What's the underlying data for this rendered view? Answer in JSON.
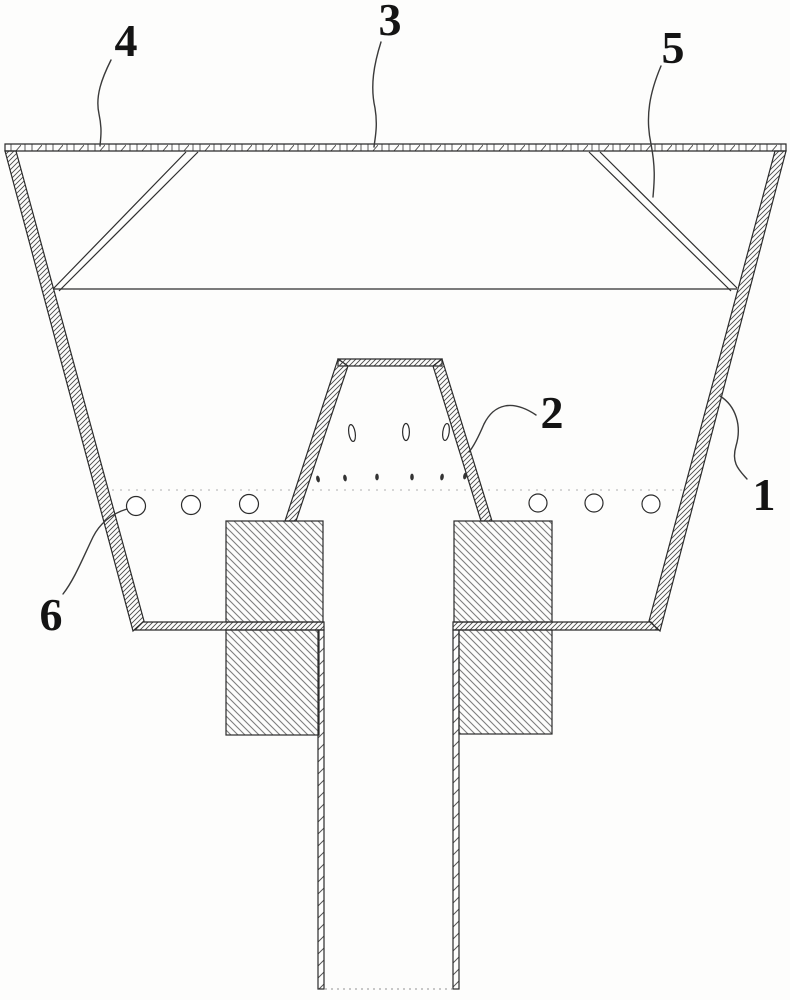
{
  "figure": {
    "kind": "patent-style cross-section technical drawing of a hopper/crucible with center discharge tube",
    "callouts": [
      {
        "text": "1"
      },
      {
        "text": "2"
      },
      {
        "text": "3"
      },
      {
        "text": "4"
      },
      {
        "text": "5"
      },
      {
        "text": "6"
      }
    ],
    "colors": {
      "line": "#2b2b2b",
      "hatch": "#7d7d7d",
      "hidden_line": "#a8a8a8",
      "background": "#fdfdfc"
    }
  }
}
